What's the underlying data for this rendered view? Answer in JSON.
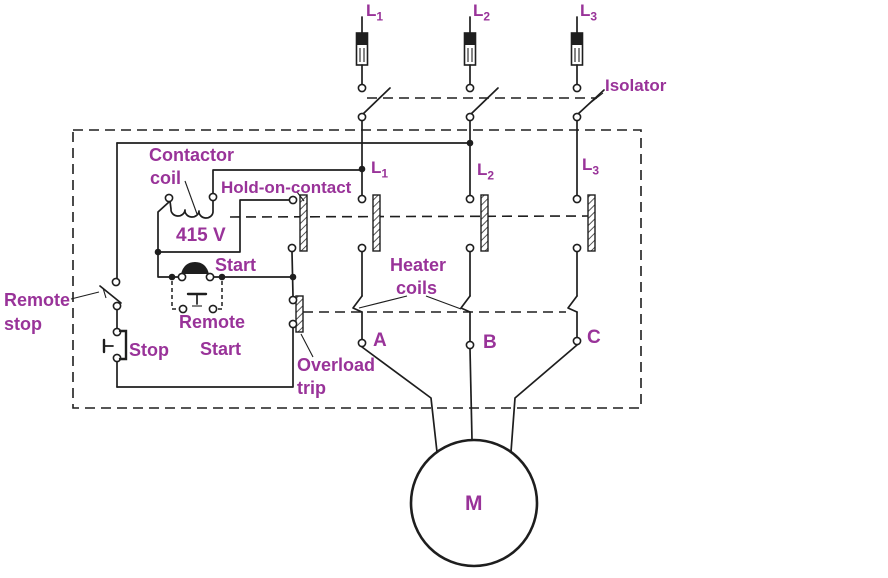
{
  "colors": {
    "line": "#1e1e1e",
    "label": "#993399",
    "background": "#ffffff"
  },
  "phases": {
    "top": [
      {
        "main": "L",
        "sub": "1"
      },
      {
        "main": "L",
        "sub": "2"
      },
      {
        "main": "L",
        "sub": "3"
      }
    ],
    "inner": [
      {
        "main": "L",
        "sub": "1"
      },
      {
        "main": "L",
        "sub": "2"
      },
      {
        "main": "L",
        "sub": "3"
      }
    ]
  },
  "labels": {
    "isolator": "Isolator",
    "contactor_coil_line1": "Contactor",
    "contactor_coil_line2": "coil",
    "hold_on_contact": "Hold-on-contact",
    "coil_voltage": "415 V",
    "start": "Start",
    "remote_start_line1": "Remote",
    "remote_start_line2": "Start",
    "stop": "Stop",
    "remote_stop_line1": "Remote",
    "remote_stop_line2": "stop",
    "overload_line1": "Overload",
    "overload_line2": "trip",
    "heater_line1": "Heater",
    "heater_line2": "coils",
    "motor": "M"
  },
  "terminals": [
    "A",
    "B",
    "C"
  ]
}
